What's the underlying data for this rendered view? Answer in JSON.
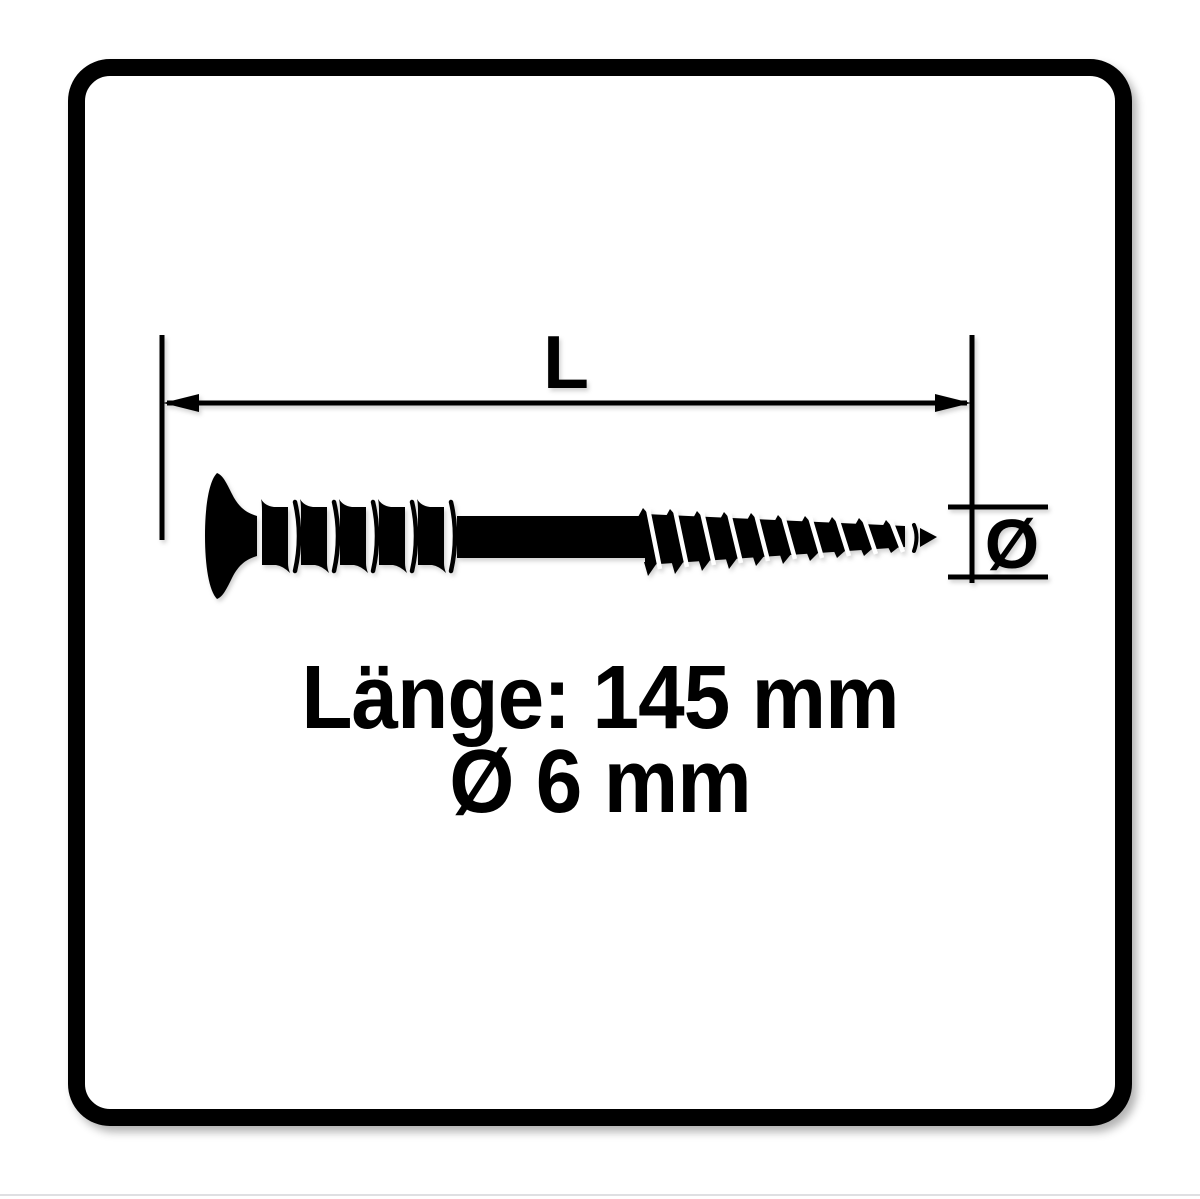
{
  "page": {
    "background_color": "#ffffff",
    "ink_color": "#000000",
    "frame_color": "#000000"
  },
  "drawing": {
    "length_label": "L",
    "diameter_symbol": "Ø"
  },
  "specs": {
    "length_line": "Länge: 145 mm",
    "diameter_line": "Ø 6 mm",
    "length_value_mm": "145",
    "diameter_value_mm": "6",
    "unit": "mm"
  }
}
